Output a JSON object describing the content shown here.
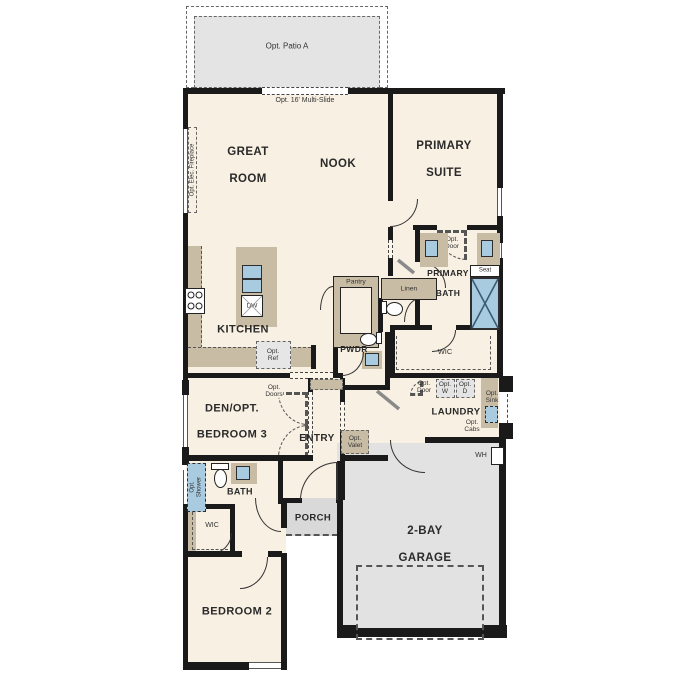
{
  "title": "Single story floor plan",
  "colors": {
    "wall": "#1a1a1a",
    "floor": "#f8f0e2",
    "counter": "#c9bca5",
    "patio": "#e4e4e4",
    "garage": "#e2e2e2",
    "porch": "#d9d9d9",
    "fixture_blue": "#a9cbe0"
  },
  "labels": {
    "opt_patio": "Opt. Patio A",
    "multi_slide": "Opt. 16' Multi-Slide",
    "great_room_1": "GREAT",
    "great_room_2": "ROOM",
    "nook": "NOOK",
    "primary_suite_1": "PRIMARY",
    "primary_suite_2": "SUITE",
    "opt_fireplace": "Opt. Elec. Fireplace",
    "kitchen": "KITCHEN",
    "dw": "DW",
    "opt_ref": "Opt.\nRef",
    "pantry": "Pantry",
    "linen": "Linen",
    "primary_bath_1": "PRIMARY",
    "primary_bath_2": "BATH",
    "opt_door_bath": "Opt.\nDoor",
    "seat": "Seat",
    "pwdr": "PWDR",
    "wic": "WIC",
    "den_1": "DEN/OPT.",
    "den_2": "BEDROOM 3",
    "opt_doors": "Opt.\nDoors",
    "entry": "ENTRY",
    "laundry": "LAUNDRY",
    "opt_door_laundry": "Opt.\nDoor",
    "opt_w": "Opt.\nW",
    "opt_d": "Opt.\nD",
    "opt_sink": "Opt.\nSink",
    "opt_cabs": "Opt.\nCabs",
    "opt_valet": "Opt.\nValet",
    "wh": "WH",
    "porch": "PORCH",
    "bath": "BATH",
    "opt_shower": "Opt.\nShower",
    "wic2": "WIC",
    "bedroom2": "BEDROOM 2",
    "garage_1": "2-BAY",
    "garage_2": "GARAGE"
  }
}
